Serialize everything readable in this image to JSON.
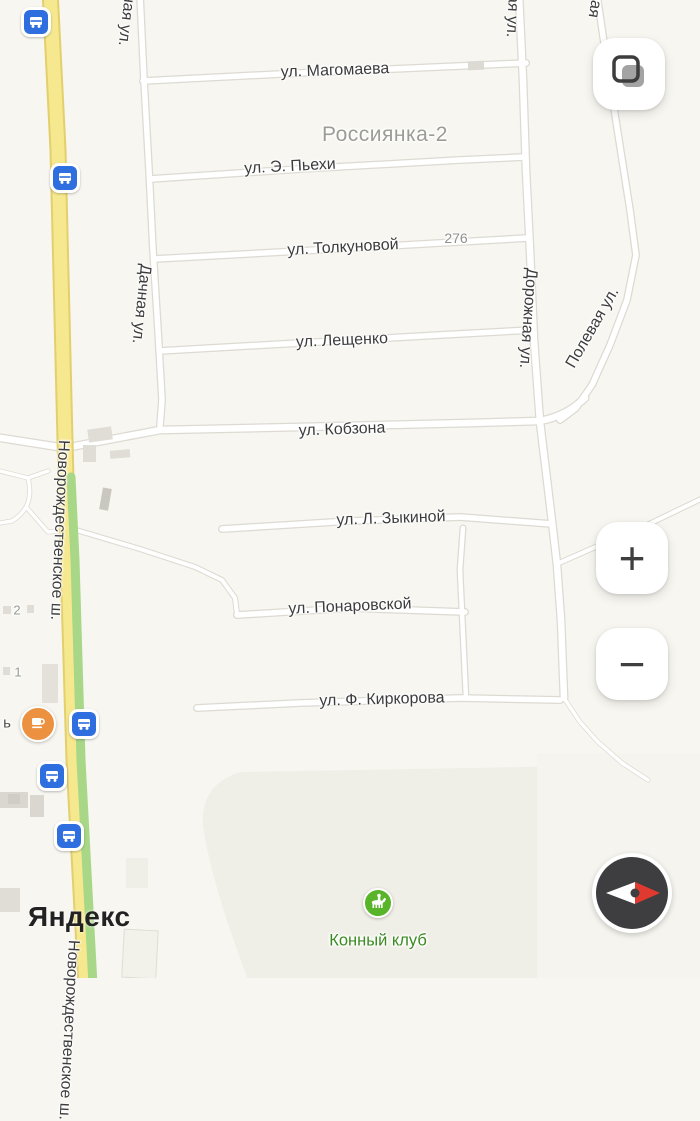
{
  "app": {
    "logo": "Яндекс"
  },
  "map": {
    "area_label": "Россиянка-2",
    "streets": {
      "magomaeva": "ул. Магомаева",
      "piekhi": "ул. Э. Пьехи",
      "tolkunovoy": "ул. Толкуновой",
      "leshchenko": "ул. Лещенко",
      "kobzona": "ул. Кобзона",
      "zykinoy": "ул. Л. Зыкиной",
      "ponarovskoy": "ул. Понаровской",
      "kirkorova": "ул. Ф. Киркорова",
      "dachnaya": "Дачная ул.",
      "dachnaya_partial": "ная ул.",
      "dorozhnaya": "Дорожная ул.",
      "dorozhnaya_partial": "ая ул.",
      "polevaya": "Полевая ул.",
      "polevaya_partial": "вая",
      "novorozhdestvenskoe": "Новорождественское ш.",
      "novorozhdestvenskoe_partial": "Новорождественское ш."
    },
    "house_numbers": {
      "n276": "276",
      "n2": "2",
      "n1": "1"
    },
    "poi": {
      "horse_club_label": "Конный клуб",
      "cut_label_tail": "ь",
      "bus_stop_count": 5
    },
    "icons": {
      "bus_stop": "bus-stop-icon",
      "cafe": "coffee-cup-icon",
      "horse_club": "horse-rider-icon",
      "layers": "layers-icon",
      "compass": "compass-needle-icon"
    },
    "colors": {
      "background": "#f7f6f0",
      "highway_yellow": "#f6e88f",
      "traffic_green": "#a7d787",
      "road_white": "#ffffff",
      "bus_icon_blue": "#2e6ede",
      "cafe_orange": "#ec9140",
      "horse_green": "#58b428",
      "green_label": "#3a8a20",
      "area_label_gray": "#9c9c96",
      "compass_red": "#e0392f",
      "street_label": "#3c3c3c"
    }
  },
  "controls": {
    "zoom_in": "+",
    "zoom_out": "−"
  }
}
